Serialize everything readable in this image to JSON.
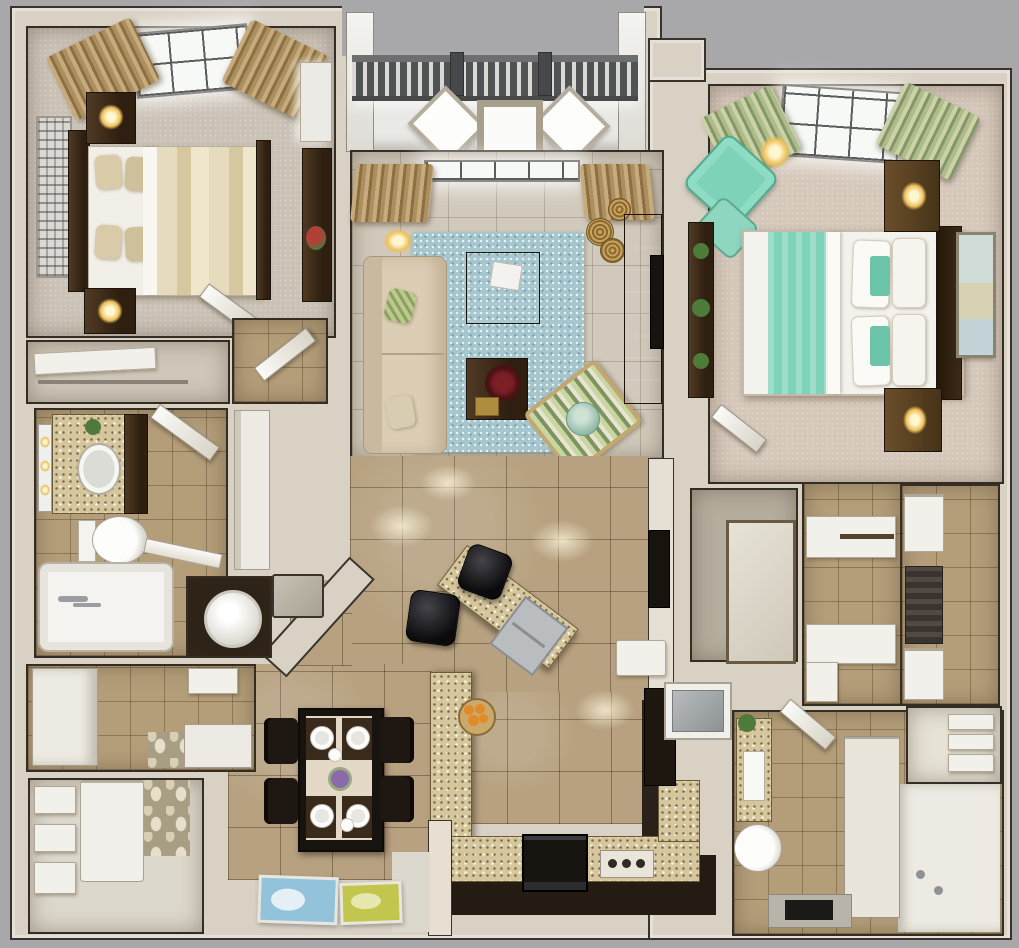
{
  "scene": {
    "description": "Photorealistic 3D rendered top-down (dollhouse) floor plan of a two-bedroom, two-bathroom apartment with balcony, open living-dining area and galley kitchen",
    "view": "top-down 3D render",
    "visible_text": ""
  },
  "palette": {
    "background": "#a8a8aa",
    "wall": "#d9d1c4",
    "wall_outline": "#332d24",
    "floor_tile": "#b7a180",
    "floor_pale": "#d1cabc",
    "floor_bath": "#b49e7a",
    "carpet_bedroom2": "#cbc2b6",
    "carpet_master": "#d5c7ba",
    "rug_blue": "#a6c6ce",
    "teal_accent": "#7fd2ba",
    "wood_dark": "#3c2b1b",
    "wood_black": "#17130e",
    "granite": "#d6c69c",
    "curtain_tan": "#b49467",
    "curtain_mint": "#aab886",
    "lamp_glow": "#f2d386",
    "white_fixture": "#f2f0ea",
    "kitchen_floor": "#241c13",
    "balcony_floor": "#e9e9e6",
    "railing_gray": "#5b5d5f",
    "pebble_floor": "#a89e84",
    "painting_blue": "#93c3da",
    "painting_yellow": "#c3c64e",
    "bowl_red": "#7c2026",
    "orange_fruit": "#e08a28",
    "flower_purple": "#8a6aa8",
    "plant_green": "#4e7a3a"
  },
  "rooms": [
    {
      "id": "balcony",
      "label": "balcony",
      "contents": [
        "railing",
        "patio chair",
        "patio chair",
        "patio table"
      ]
    },
    {
      "id": "bedroom-2",
      "label": "second bedroom",
      "contents": [
        "window",
        "curtains",
        "queen bed",
        "pillows",
        "striped duvet",
        "headboard",
        "nightstand with lamp",
        "nightstand with lamp",
        "wall art",
        "dresser",
        "wardrobe",
        "red plant",
        "door"
      ]
    },
    {
      "id": "living-room",
      "label": "living room",
      "contents": [
        "window",
        "curtains",
        "floor lamp",
        "sectional sofa",
        "throw pillows",
        "blue area rug",
        "coffee table with magazine",
        "coffee table with red bowl",
        "striped accent chair",
        "round pillow",
        "wicker baskets",
        "media wall unit",
        "flat tv"
      ]
    },
    {
      "id": "bathroom-2",
      "label": "guest bathroom",
      "contents": [
        "vanity with sink",
        "mirror lights",
        "tall cabinet",
        "toilet",
        "bathtub",
        "towel rack",
        "plant"
      ]
    },
    {
      "id": "closet-2",
      "label": "bedroom closet",
      "contents": [
        "shelf",
        "door panel"
      ]
    },
    {
      "id": "laundry-closet",
      "label": "utility closet",
      "contents": [
        "washer"
      ]
    },
    {
      "id": "entry-hall",
      "label": "entry hall",
      "contents": [
        "console cabinets",
        "pebble floor inlay",
        "floating shelf"
      ]
    },
    {
      "id": "laundry-room",
      "label": "laundry / storage room",
      "contents": [
        "wall shelves",
        "stacked appliance",
        "pebble floor inlay"
      ]
    },
    {
      "id": "dining-area",
      "label": "dining area",
      "contents": [
        "dining table",
        "four chairs",
        "four place settings",
        "flower centerpiece",
        "blue painting",
        "yellow painting"
      ]
    },
    {
      "id": "kitchen",
      "label": "kitchen",
      "contents": [
        "breakfast bar",
        "bar sink",
        "bar stool",
        "bar stool",
        "fruit bowl with oranges",
        "range",
        "cooktop knobs",
        "granite counters",
        "refrigerator",
        "tall dark cabinet"
      ]
    },
    {
      "id": "master-bedroom",
      "label": "master bedroom",
      "contents": [
        "window",
        "mint curtains",
        "bed with teal throw",
        "pillows",
        "headboard",
        "nightstand with lamp",
        "nightstand with lamp",
        "wall sconce",
        "teal lounge chair",
        "ottoman",
        "plant shelf",
        "framed map art",
        "door"
      ]
    },
    {
      "id": "walk-in-closet-left",
      "label": "closet with mirror door",
      "contents": [
        "mirror door"
      ]
    },
    {
      "id": "walk-in-closet-middle",
      "label": "walk-in closet",
      "contents": [
        "corner shelves",
        "hanging rod"
      ]
    },
    {
      "id": "walk-in-closet-right",
      "label": "walk-in closet",
      "contents": [
        "shelf stack",
        "hanging clothes"
      ]
    },
    {
      "id": "master-bathroom",
      "label": "master bathroom",
      "contents": [
        "mosaic vanity with sink",
        "plant",
        "toilet",
        "partition cabinet",
        "shower area",
        "bath mat",
        "door",
        "linen closet with towels"
      ]
    }
  ]
}
